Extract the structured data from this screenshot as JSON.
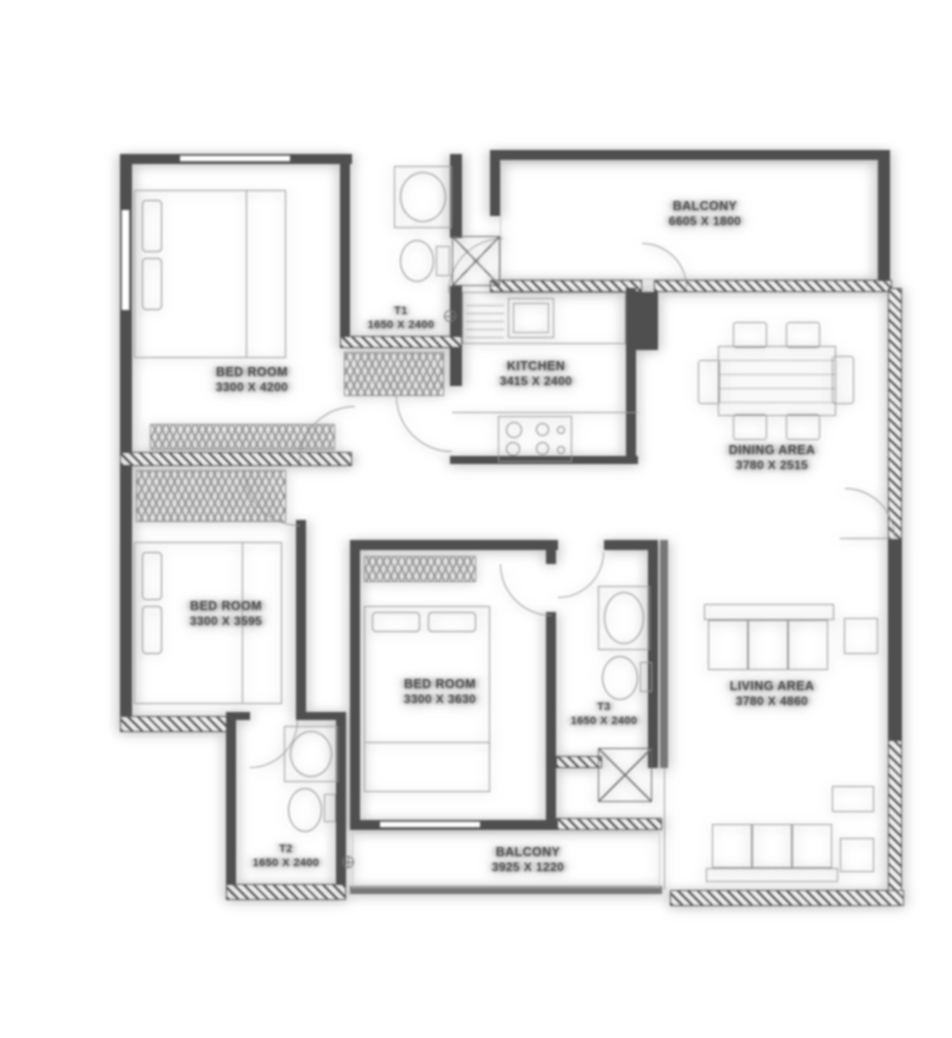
{
  "plan": {
    "rooms": {
      "bedroom_top_left": {
        "name": "BED ROOM",
        "dims": "3300 X 4200"
      },
      "toilet_t1": {
        "name": "T1",
        "dims": "1650 X 2400"
      },
      "balcony_top": {
        "name": "BALCONY",
        "dims": "6605 X 1800"
      },
      "kitchen": {
        "name": "KITCHEN",
        "dims": "3415 X 2400"
      },
      "dining": {
        "name": "DINING AREA",
        "dims": "3780 X 2515"
      },
      "bedroom_mid_left": {
        "name": "BED ROOM",
        "dims": "3300 X 3595"
      },
      "bedroom_center": {
        "name": "BED ROOM",
        "dims": "3300 X 3630"
      },
      "toilet_t3": {
        "name": "T3",
        "dims": "1650 X 2400"
      },
      "living": {
        "name": "LIVING AREA",
        "dims": "3780 X 4860"
      },
      "toilet_t2": {
        "name": "T2",
        "dims": "1650 X 2400"
      },
      "balcony_bottom": {
        "name": "BALCONY",
        "dims": "3925 X 1220"
      }
    },
    "icons": {
      "datum_marker": "circle-cross"
    },
    "colors": {
      "background": "#ffffff",
      "wall": "#4f4f4f",
      "line": "#9b9b9b",
      "label_text": "#4a4a4a"
    }
  }
}
